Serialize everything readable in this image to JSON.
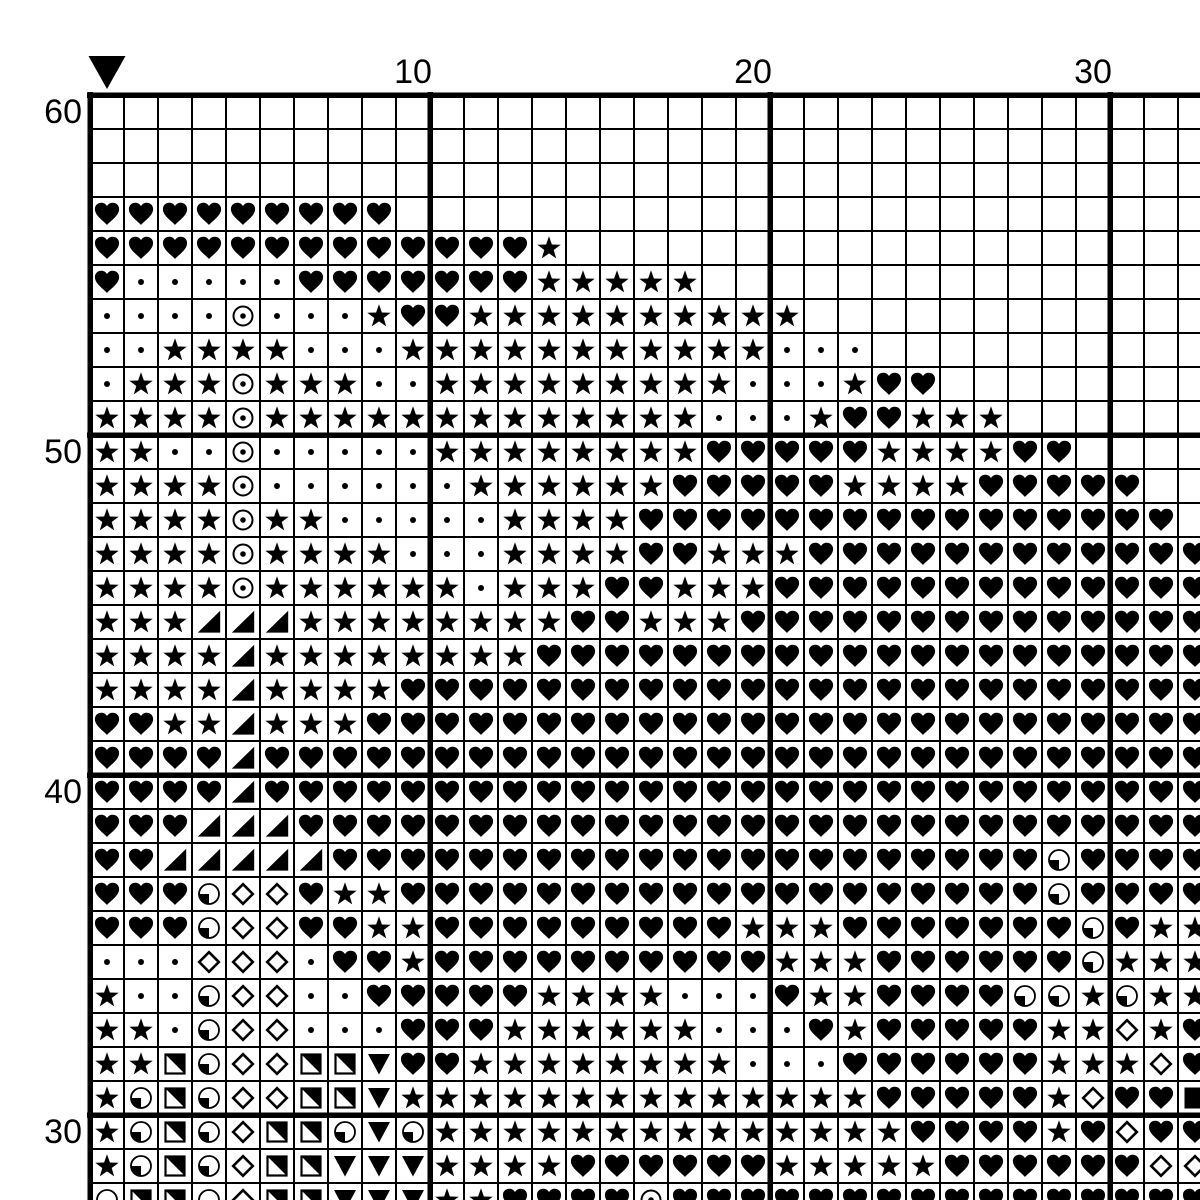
{
  "colors": {
    "ink": "#000000",
    "paper": "#ffffff"
  },
  "axis": {
    "column_labels": [
      {
        "col": 10,
        "text": "10"
      },
      {
        "col": 20,
        "text": "20"
      },
      {
        "col": 30,
        "text": "30"
      }
    ],
    "row_labels": [
      {
        "row": 60,
        "text": "60"
      },
      {
        "row": 50,
        "text": "50"
      },
      {
        "row": 40,
        "text": "40"
      },
      {
        "row": 30,
        "text": "30"
      }
    ]
  },
  "marker": {
    "icon": "center-marker-down-triangle-icon",
    "col": 1
  },
  "legend": {
    "H": "black-heart",
    "S": "black-star",
    "d": "small-dot",
    "O": "circled-dot",
    "T": "lower-right-black-triangle",
    "Q": "circle-lower-left-quarter-black",
    "D": "white-diamond",
    "N": "square-upper-right-half-black",
    "V": "black-down-triangle",
    "F": "black-square",
    ".": "empty"
  },
  "chart_data": {
    "type": "table",
    "description": "cross-stitch symbol grid, visible region cols 1-33, rows 60 down to 28, bold gridlines every 10 cells",
    "top_row": 60,
    "left_col": 1,
    "rows": [
      {
        "row": 60,
        "cells": "................................."
      },
      {
        "row": 59,
        "cells": "................................."
      },
      {
        "row": 58,
        "cells": "................................."
      },
      {
        "row": 57,
        "cells": "HHHHHHHHH........................"
      },
      {
        "row": 56,
        "cells": "HHHHHHHHHHHHHS..................."
      },
      {
        "row": 55,
        "cells": "HdddddHHHHHHHSSSSS..............."
      },
      {
        "row": 54,
        "cells": "ddddOdddSHHSSSSSSSSSS............"
      },
      {
        "row": 53,
        "cells": "ddSSSSdddSSSSSSSSSSSddd.........."
      },
      {
        "row": 52,
        "cells": "dSSSOSSSddSSSSSSSSSdddSHH........"
      },
      {
        "row": 51,
        "cells": "SSSSOSSSSSSSSSSSSSdddSHHSSS......"
      },
      {
        "row": 50,
        "cells": "SSddOdddddSSSSSSSSHHHHHSSSSHH...."
      },
      {
        "row": 49,
        "cells": "SSSSOddddddSSSSSSHHHHHSSSSHHHHH.."
      },
      {
        "row": 48,
        "cells": "SSSSOSSdddddSSSSHHHHHHHHHHHHHHHH."
      },
      {
        "row": 47,
        "cells": "SSSSOSSSSdddSSSSHHSSSHHHHHHHHHHHH"
      },
      {
        "row": 46,
        "cells": "SSSSOSSSSSSdSSSHHSSSHHHHHHHHHHHHH"
      },
      {
        "row": 45,
        "cells": "SSSTTTSSSSSSSSHHSSSHHHHHHHHHHHHHH"
      },
      {
        "row": 44,
        "cells": "SSSSTSSSSSSSSHHHHHHHHHHHHHHHHHHHH"
      },
      {
        "row": 43,
        "cells": "SSSSTSSSSHHHHHHHHHHHHHHHHHHHHHHHH"
      },
      {
        "row": 42,
        "cells": "HHSSTSSSHHHHHHHHHHHHHHHHHHHHHHHHH"
      },
      {
        "row": 41,
        "cells": "HHHHTHHHHHHHHHHHHHHHHHHHHHHHHHHHH"
      },
      {
        "row": 40,
        "cells": "HHHHTHHHHHHHHHHHHHHHHHHHHHHHHHHHH"
      },
      {
        "row": 39,
        "cells": "HHHTTTHHHHHHHHHHHHHHHHHHHHHHHHHHH"
      },
      {
        "row": 38,
        "cells": "HHTTTTTHHHHHHHHHHHHHHHHHHHHHQHHHH"
      },
      {
        "row": 37,
        "cells": "HHHQDDHSSHHHHHHHHHHHHHHHHHHHQHHHH"
      },
      {
        "row": 36,
        "cells": "HHHQDDHHSSHHHHHHHHHSSSHHHHHHHQHSS"
      },
      {
        "row": 35,
        "cells": "dddDDDdHHSHHHHHHHHHHSSSHHHHHHQSSS"
      },
      {
        "row": 34,
        "cells": "SddQDDddHHHHHSSSSdddHSSHHHHQQSQSS"
      },
      {
        "row": 33,
        "cells": "SSdQDDdddHHHSSSSSSdddHSHHHHHSSDSH"
      },
      {
        "row": 32,
        "cells": "SSNQDDNNVHHSSSSSSSSdddHHHHHHSSSDH"
      },
      {
        "row": 31,
        "cells": "SQNQDDNNVSSSSSSSSSSSSSSHHHHHSDHHF"
      },
      {
        "row": 30,
        "cells": "SQNQDNNQVQSSSSSSSSSSSSSSHHHHSHDHH"
      },
      {
        "row": 29,
        "cells": "SQNQDNNVVVSSSSHHHHHHSSSSSHHHHHHDD"
      },
      {
        "row": 28,
        "cells": "QNNQDNNVVVSSHHHHOHHHHHHHHHHHHHHHH"
      }
    ]
  }
}
